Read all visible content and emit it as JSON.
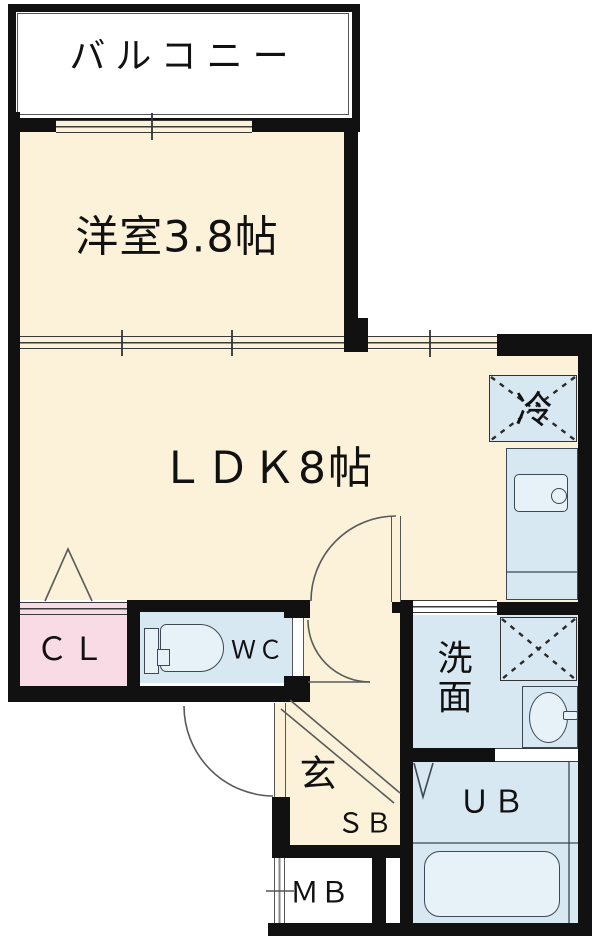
{
  "title": "1LDK apartment floor plan",
  "palette": {
    "wall": "#111111",
    "cream": "#fcf2da",
    "pink": "#f8dbe4",
    "pink-deep": "#f6ccd8",
    "blue": "#d7e8f3",
    "blue-light": "#e7f1f8",
    "line": "#3c4854",
    "thin": "#5a5a5a",
    "white": "#ffffff"
  },
  "rooms": {
    "balcony": {
      "label": "バルコニー"
    },
    "western_room": {
      "label": "洋室3.8帖"
    },
    "ldk": {
      "label": "ＬＤＫ8帖"
    },
    "refrigerator": {
      "label": "冷"
    },
    "closet": {
      "label": "ＣＬ"
    },
    "toilet": {
      "label": "ＷＣ"
    },
    "washroom": {
      "chars": [
        "洗",
        "面"
      ]
    },
    "entrance": {
      "label": "玄"
    },
    "shoe_box": {
      "label": "ＳＢ"
    },
    "meter_box": {
      "label": "ＭＢ"
    },
    "unit_bath": {
      "label": "ＵＢ"
    }
  }
}
